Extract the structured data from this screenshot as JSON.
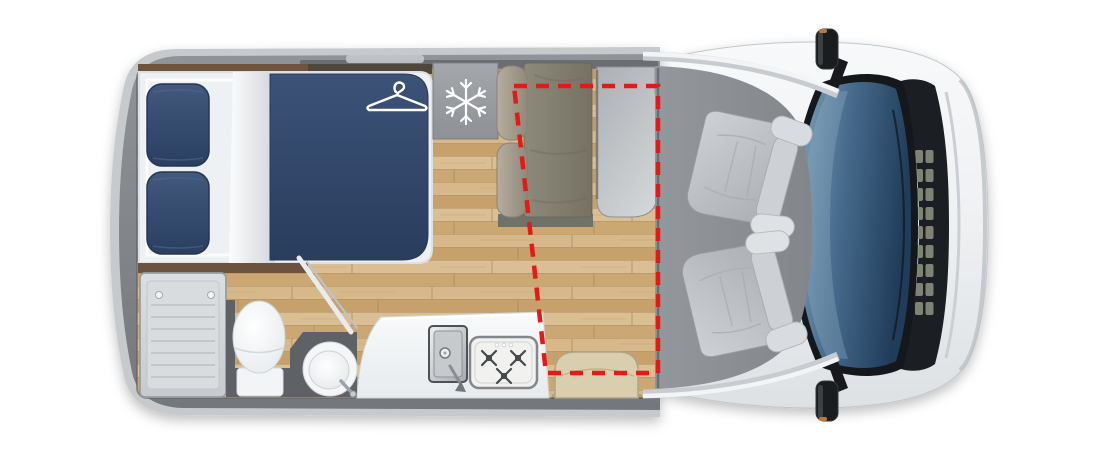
{
  "scene": {
    "kind": "motorhome-floorplan",
    "view": "top-down",
    "background": "#ffffff"
  },
  "icons": [
    {
      "name": "hanger-icon",
      "meaning": "wardrobe storage under bed",
      "color": "#ffffff"
    },
    {
      "name": "snowflake-icon",
      "meaning": "refrigerator",
      "color": "#ffffff"
    }
  ],
  "highlight": {
    "name": "lounge-conversion-zone",
    "style": "dashed outline",
    "color": "#e31b17",
    "polygon": [
      [
        514,
        86
      ],
      [
        658,
        86
      ],
      [
        658,
        373
      ],
      [
        546,
        373
      ]
    ]
  },
  "areas": {
    "bedroom": {
      "items": [
        "double-bed",
        "pillow",
        "pillow",
        "duvet",
        "wardrobe (hanger icon)"
      ]
    },
    "galley": {
      "items": [
        "fridge (snowflake icon)",
        "kitchen-counter",
        "kitchen-sink",
        "three-burner-hob"
      ]
    },
    "bathroom": {
      "items": [
        "shower-tray",
        "toilet",
        "washbasin",
        "diagonal-door"
      ]
    },
    "lounge": {
      "items": [
        "bench-seat",
        "table",
        "stool-seat"
      ]
    },
    "cab": {
      "items": [
        "driver-swivel-seat",
        "passenger-swivel-seat",
        "windshield",
        "side-mirror",
        "side-mirror"
      ]
    }
  },
  "colors": {
    "accent_red": "#e31b17",
    "wood_floor": "#d2b385",
    "duvet_navy": "#32496e",
    "wall_gray": "#82868a",
    "cab_floor_gray": "#8b8f93",
    "windshield_blue": "#3c6084",
    "upholstery_taupe": "#827e70",
    "stool_beige": "#d8cdab",
    "fixture_white": "#f4f6f8"
  }
}
